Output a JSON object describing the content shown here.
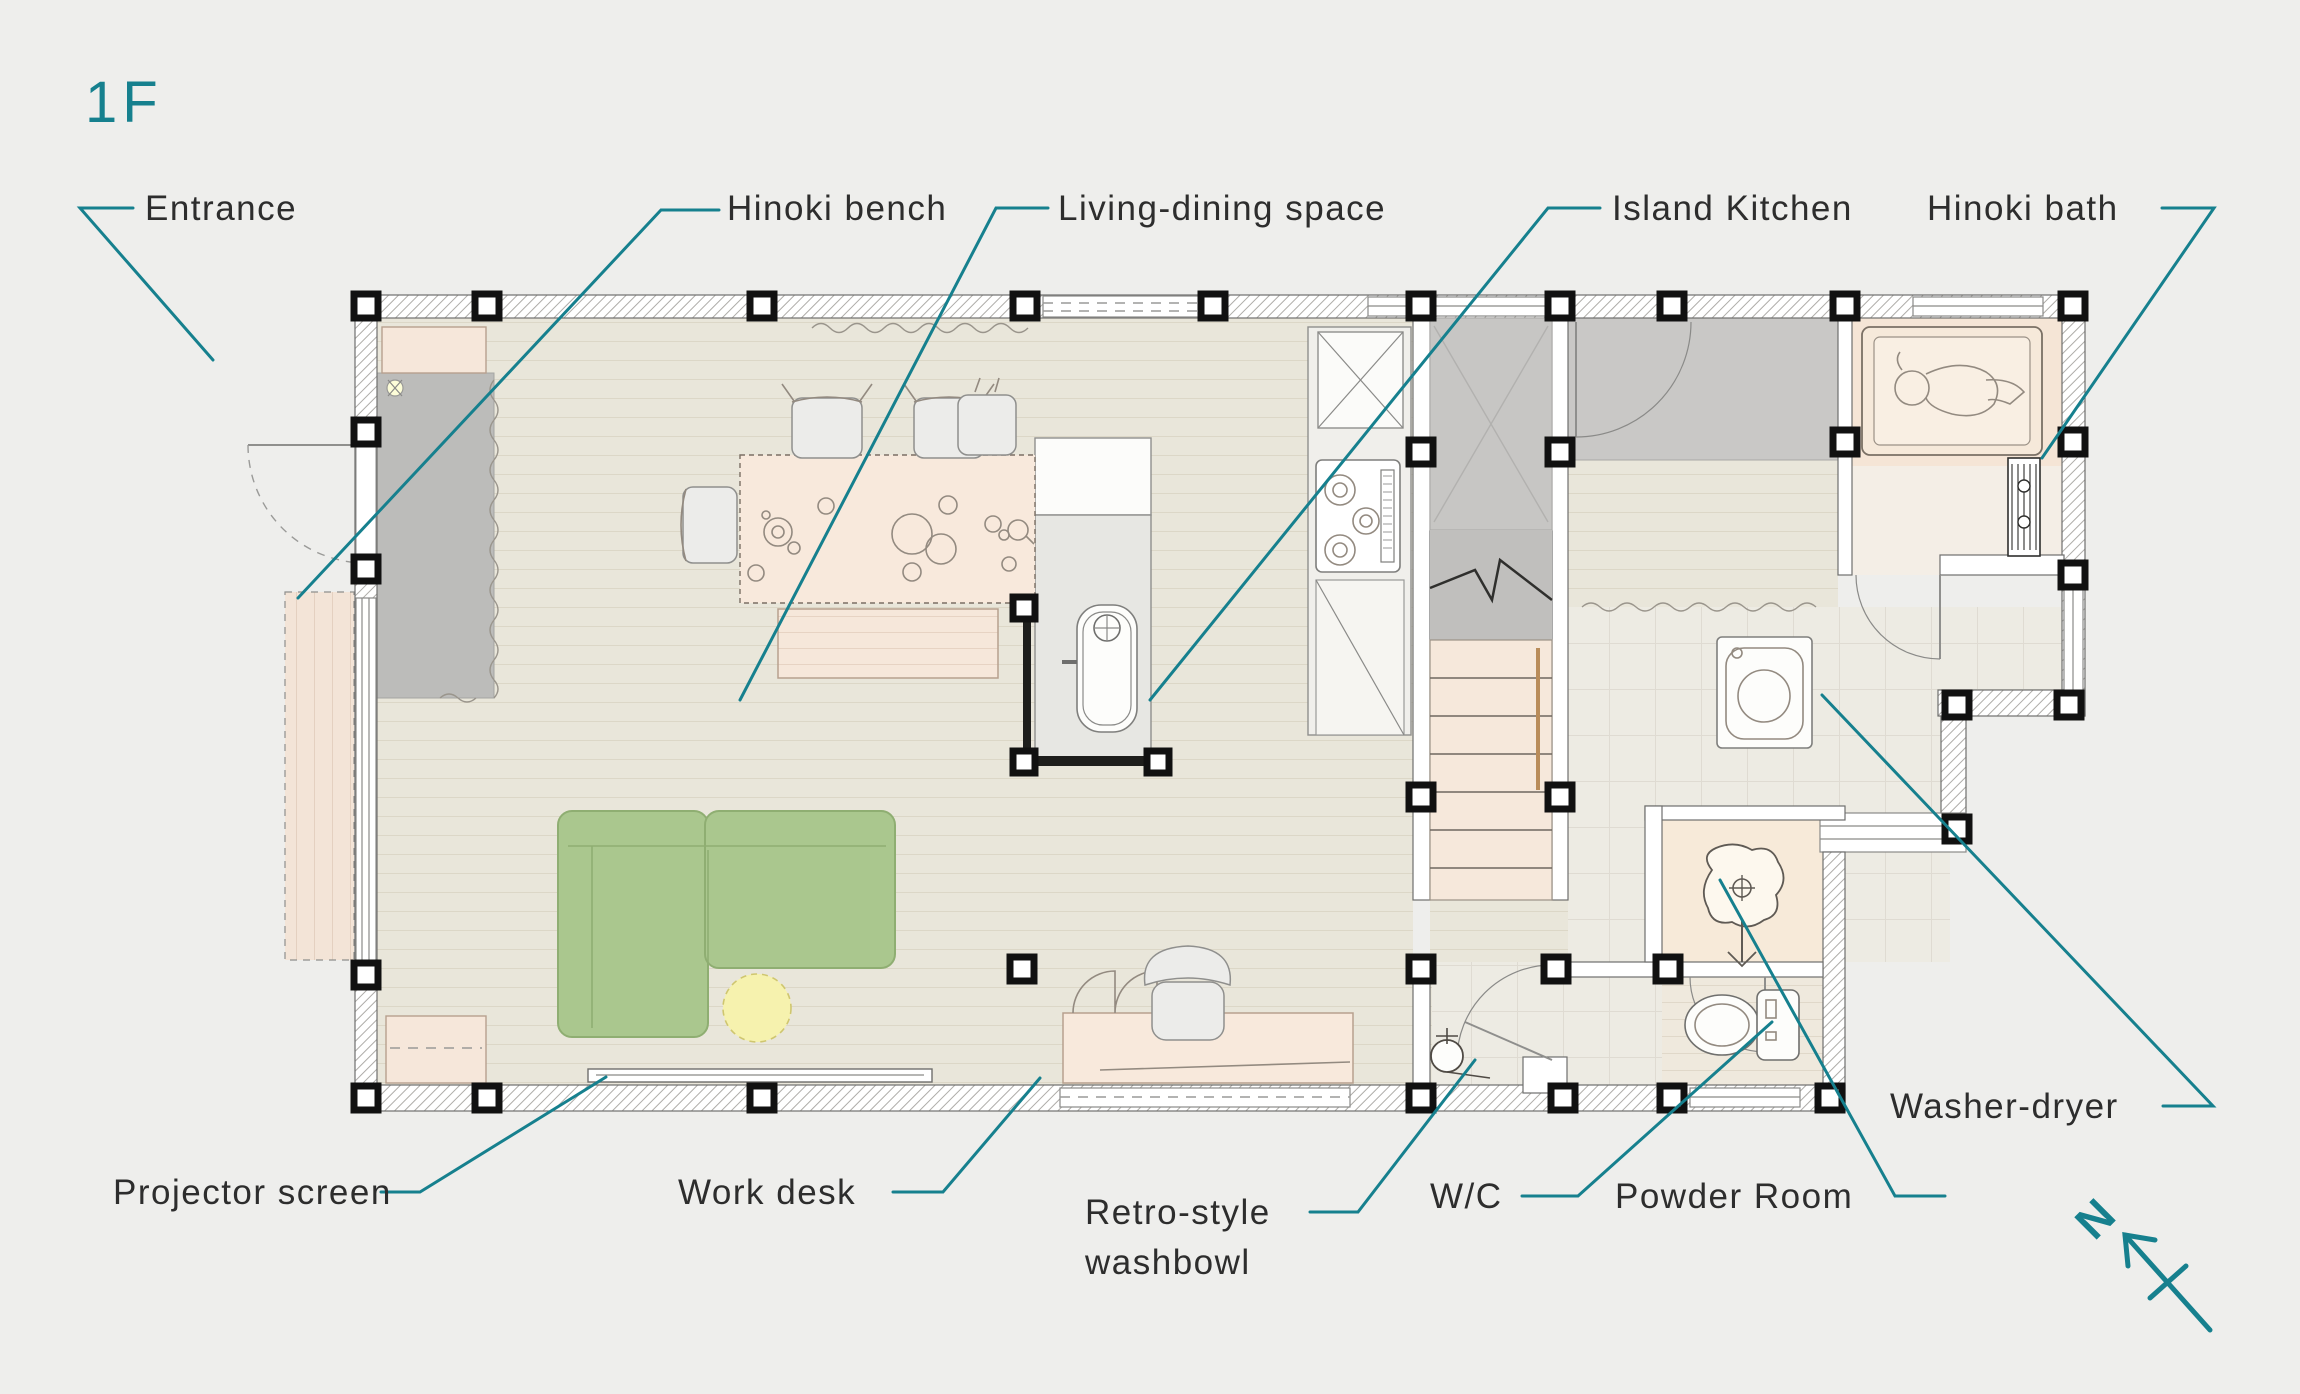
{
  "title": "1F",
  "north": "N",
  "colors": {
    "accent_teal": "#16808E",
    "label_text": "#2D2D2D",
    "background": "#EEEEEC",
    "wood_floor": "#E9E6DA",
    "furniture_wood": "#F8E9DC",
    "sofa_green": "#AAC78E",
    "rug_yellow": "#F6F2AE",
    "entrance_gray": "#BCBCBA",
    "tile_gray": "#EDEBE3"
  },
  "labels": {
    "entrance": "Entrance",
    "hinoki_bench": "Hinoki bench",
    "living_dining_space": "Living-dining space",
    "island_kitchen": "Island Kitchen",
    "hinoki_bath": "Hinoki bath",
    "washer_dryer": "Washer-dryer",
    "projector_screen": "Projector screen",
    "work_desk": "Work desk",
    "retro_washbowl_line1": "Retro-style",
    "retro_washbowl_line2": "washbowl",
    "wc": "W/C",
    "powder_room": "Powder Room"
  }
}
